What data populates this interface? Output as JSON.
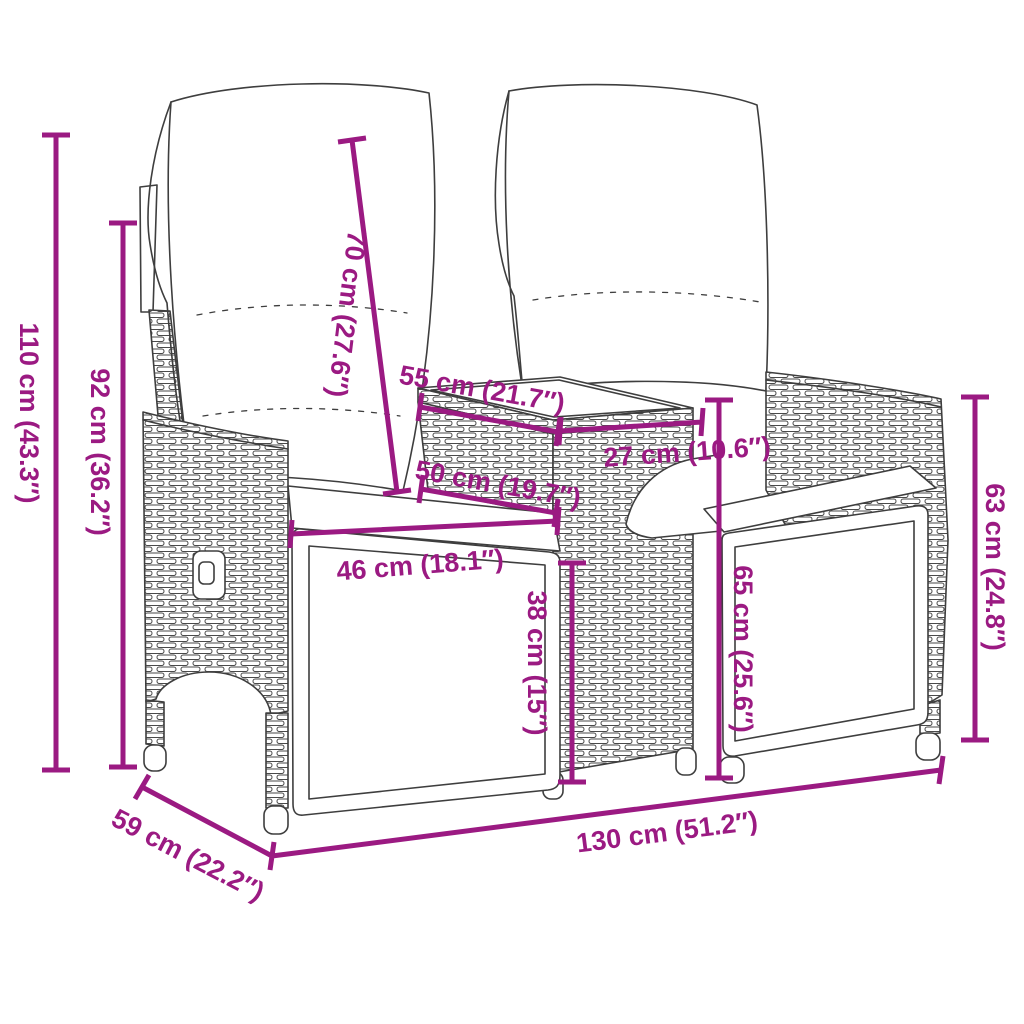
{
  "diagram": {
    "background": "#ffffff",
    "accent_color": "#9b1a82",
    "art_line_color": "#3e3e3e",
    "subject": "dimension-diagram",
    "dimensions": {
      "total_height": {
        "cm": 110,
        "inches": 43.3,
        "label": "110 cm (43.3″)"
      },
      "back_height": {
        "cm": 92,
        "inches": 36.2,
        "label": "92 cm (36.2″)"
      },
      "backrest_length": {
        "cm": 70,
        "inches": 27.6,
        "label": "70 cm (27.6″)"
      },
      "table_length": {
        "cm": 55,
        "inches": 21.7,
        "label": "55 cm (21.7″)"
      },
      "seat_depth": {
        "cm": 50,
        "inches": 19.7,
        "label": "50 cm (19.7″)"
      },
      "table_width": {
        "cm": 27,
        "inches": 10.6,
        "label": "27 cm (10.6″)"
      },
      "seat_width": {
        "cm": 46,
        "inches": 18.1,
        "label": "46 cm (18.1″)"
      },
      "seat_height": {
        "cm": 38,
        "inches": 15,
        "label": "38 cm (15″)"
      },
      "table_height": {
        "cm": 65,
        "inches": 25.6,
        "label": "65 cm (25.6″)"
      },
      "armrest_height": {
        "cm": 63,
        "inches": 24.8,
        "label": "63 cm (24.8″)"
      },
      "total_depth": {
        "cm": 59,
        "inches": 22.2,
        "label": "59 cm (22.2″)"
      },
      "total_width": {
        "cm": 130,
        "inches": 51.2,
        "label": "130 cm (51.2″)"
      }
    }
  }
}
